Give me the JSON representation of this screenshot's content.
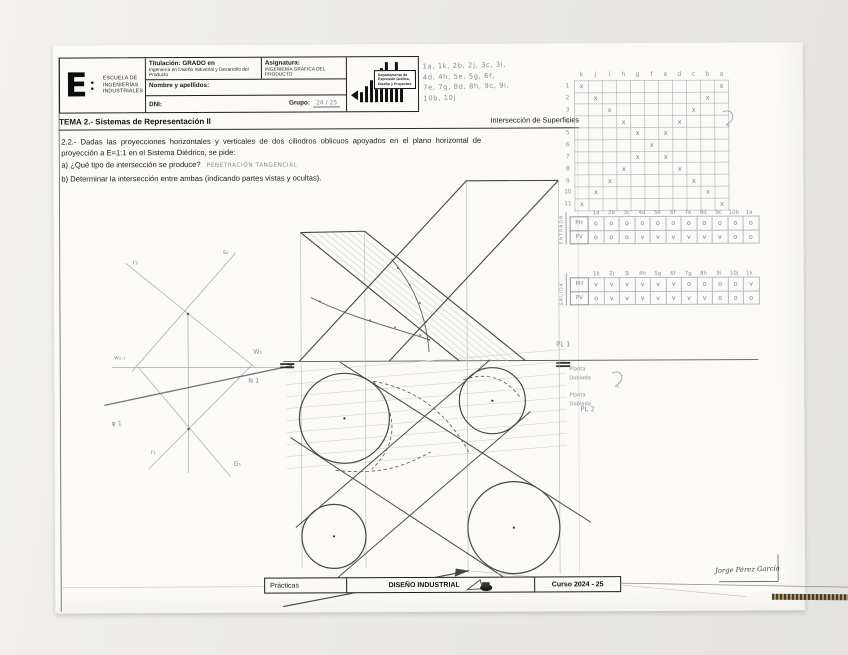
{
  "header": {
    "logo_letter": "E",
    "logo_dots": "● ●",
    "school_lines": [
      "ESCUELA DE",
      "INGENIERÍAS",
      "INDUSTRIALES"
    ],
    "titulacion_label": "Titulación: GRADO en",
    "titulacion_value": "Ingeniería en Diseño Industrial y Desarrollo del Producto",
    "asignatura_label": "Asignatura:",
    "asignatura_value": "INGENIERÍA GRÁFICA DEL PRODUCTO",
    "nombre_label": "Nombre y apellidos:",
    "dni_label": "DNI:",
    "grupo_label": "Grupo:",
    "grupo_value": "24 / 25",
    "dept_lines": [
      "Departamento de",
      "Expresión Gráfica,",
      "Diseño y Proyectos"
    ]
  },
  "tema": {
    "left": "TEMA 2.- Sistemas de Representación II",
    "right": "Intersección de Superficies"
  },
  "problem": {
    "statement": "2.2.- Dadas las proyecciones horizontales y verticales de dos cilindros oblicuos apoyados en el plano horizontal de proyección a E=1:1 en el Sistema Diédrico, se pide:",
    "item_a": "a) ¿Qué tipo de intersección se produce?",
    "item_a_answer": "PENETRACIÓN TANGENCIAL",
    "item_b": "b) Determinar la intersección entre ambas (indicando partes vistas y ocultas)."
  },
  "notes": {
    "list_lines": [
      "1a, 1k, 2b, 2j, 3c, 3i,",
      "4d, 4h, 5e, 5g, 6f,",
      "7e, 7g, 8d, 8h, 9c, 9i,",
      "10b, 10j"
    ],
    "grid": {
      "columns": [
        "k",
        "j",
        "i",
        "h",
        "g",
        "f",
        "e",
        "d",
        "c",
        "b",
        "a"
      ],
      "rows": [
        "1",
        "2",
        "3",
        "4",
        "5",
        "6",
        "7",
        "8",
        "9",
        "10",
        "11"
      ],
      "marks": [
        [
          0,
          10
        ],
        [
          1,
          9
        ],
        [
          2,
          8
        ],
        [
          3,
          7
        ],
        [
          4,
          6
        ],
        [
          5
        ],
        [
          4,
          6
        ],
        [
          3,
          7
        ],
        [
          2,
          8
        ],
        [
          1,
          9
        ],
        [
          0,
          10
        ]
      ],
      "mark_symbol": "x"
    }
  },
  "tables": {
    "row_labels": [
      "PH",
      "PV"
    ],
    "entrada": {
      "side_label": "ENTRADA",
      "headers": [
        "1a",
        "2b",
        "3c",
        "4d",
        "5e",
        "6f",
        "7e",
        "8d",
        "9c",
        "10b",
        "1a"
      ],
      "ph": [
        "o",
        "o",
        "o",
        "o",
        "o",
        "o",
        "o",
        "o",
        "o",
        "o",
        "o"
      ],
      "pv": [
        "o",
        "o",
        "o",
        "v",
        "v",
        "v",
        "v",
        "v",
        "v",
        "o",
        "o"
      ]
    },
    "salida": {
      "side_label": "SALIDA",
      "headers": [
        "1k",
        "2j",
        "3i",
        "4h",
        "5g",
        "6f",
        "7g",
        "8h",
        "9i",
        "10j",
        "1k"
      ],
      "ph": [
        "v",
        "v",
        "v",
        "v",
        "v",
        "v",
        "o",
        "o",
        "o",
        "o",
        "v"
      ],
      "pv": [
        "o",
        "v",
        "v",
        "v",
        "v",
        "v",
        "v",
        "v",
        "o",
        "o",
        "o"
      ]
    }
  },
  "drawing": {
    "labels": [
      {
        "t": "PL 1",
        "x": 556,
        "y": 347,
        "s": 6.8
      },
      {
        "t": "PL 2",
        "x": 580,
        "y": 412,
        "s": 6.8
      },
      {
        "t": "Planta",
        "x": 569,
        "y": 371,
        "s": 5.2
      },
      {
        "t": "Doblada",
        "x": 569,
        "y": 380,
        "s": 5.2
      },
      {
        "t": "Planta",
        "x": 569,
        "y": 397,
        "s": 5.2
      },
      {
        "t": "Doblada",
        "x": 569,
        "y": 406,
        "s": 5.2
      },
      {
        "t": "r₂",
        "x": 133,
        "y": 263,
        "s": 6.4
      },
      {
        "t": "s₂",
        "x": 223,
        "y": 253,
        "s": 6.4
      },
      {
        "t": "w₂.₁",
        "x": 114,
        "y": 358,
        "s": 5.8
      },
      {
        "t": "W₂",
        "x": 253,
        "y": 353,
        "s": 6.4
      },
      {
        "t": "N 1",
        "x": 248,
        "y": 382,
        "s": 6.4
      },
      {
        "t": "φ 1",
        "x": 111,
        "y": 424,
        "s": 6.4
      },
      {
        "t": "r₁",
        "x": 150,
        "y": 453,
        "s": 6.4
      },
      {
        "t": "G₁",
        "x": 233,
        "y": 465,
        "s": 6.4
      }
    ]
  },
  "footer": {
    "practicas": "Prácticas",
    "center": "DISEÑO INDUSTRIAL",
    "curso": "Curso 2024 - 25"
  },
  "signature": "Jorge Pérez García"
}
